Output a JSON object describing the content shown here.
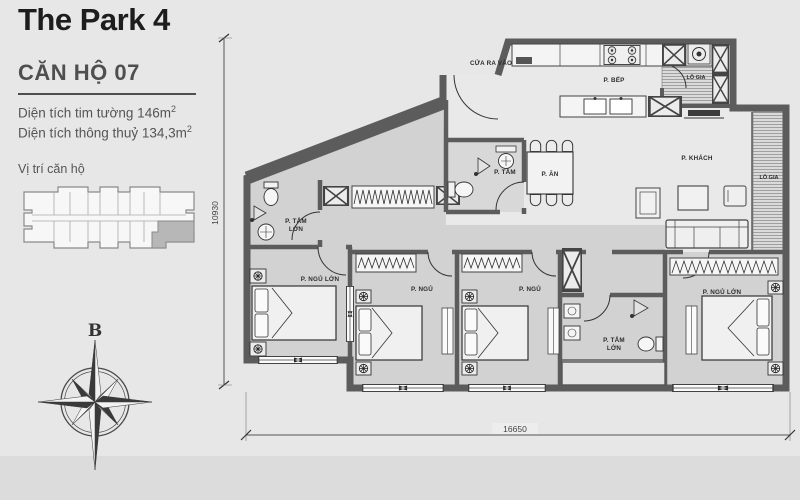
{
  "header": {
    "title": "The Park 4"
  },
  "sidebar": {
    "unit_title": "CĂN HỘ 07",
    "area_line1": "Diện tích tim tường 146m",
    "area_line1_sup": "2",
    "area_line2": "Diện tích thông thuỷ 134,3m",
    "area_line2_sup": "2",
    "location_label": "Vị trí căn hộ",
    "compass_north_label": "B"
  },
  "plan": {
    "labels": {
      "entrance": "CỬA RA VÀO",
      "kitchen": "P. BẾP",
      "loggia_kitchen": "LÔ GIA",
      "loggia_living": "LÔ GIA",
      "living": "P. KHÁCH",
      "dining": "P. ĂN",
      "bath": "P. TẮM",
      "bath_master_1_line1": "P. TẮM",
      "bath_master_1_line2": "LỚN",
      "bath_master_2_line1": "P. TẮM",
      "bath_master_2_line2": "LỚN",
      "bedroom_master_1": "P. NGỦ LỚN",
      "bedroom_2": "P. NGỦ",
      "bedroom_3": "P. NGỦ",
      "bedroom_master_2": "P. NGỦ LỚN"
    },
    "dimensions": {
      "width_mm": "16650",
      "height_mm": "10930"
    }
  },
  "colors": {
    "wall": "#5c5c5c",
    "room_fill": "#d2d2d2",
    "background": "#e7e7e7",
    "unit_highlight": "#b7b7b7",
    "text_dark": "#1d1d1d",
    "text_gray": "#555555"
  }
}
